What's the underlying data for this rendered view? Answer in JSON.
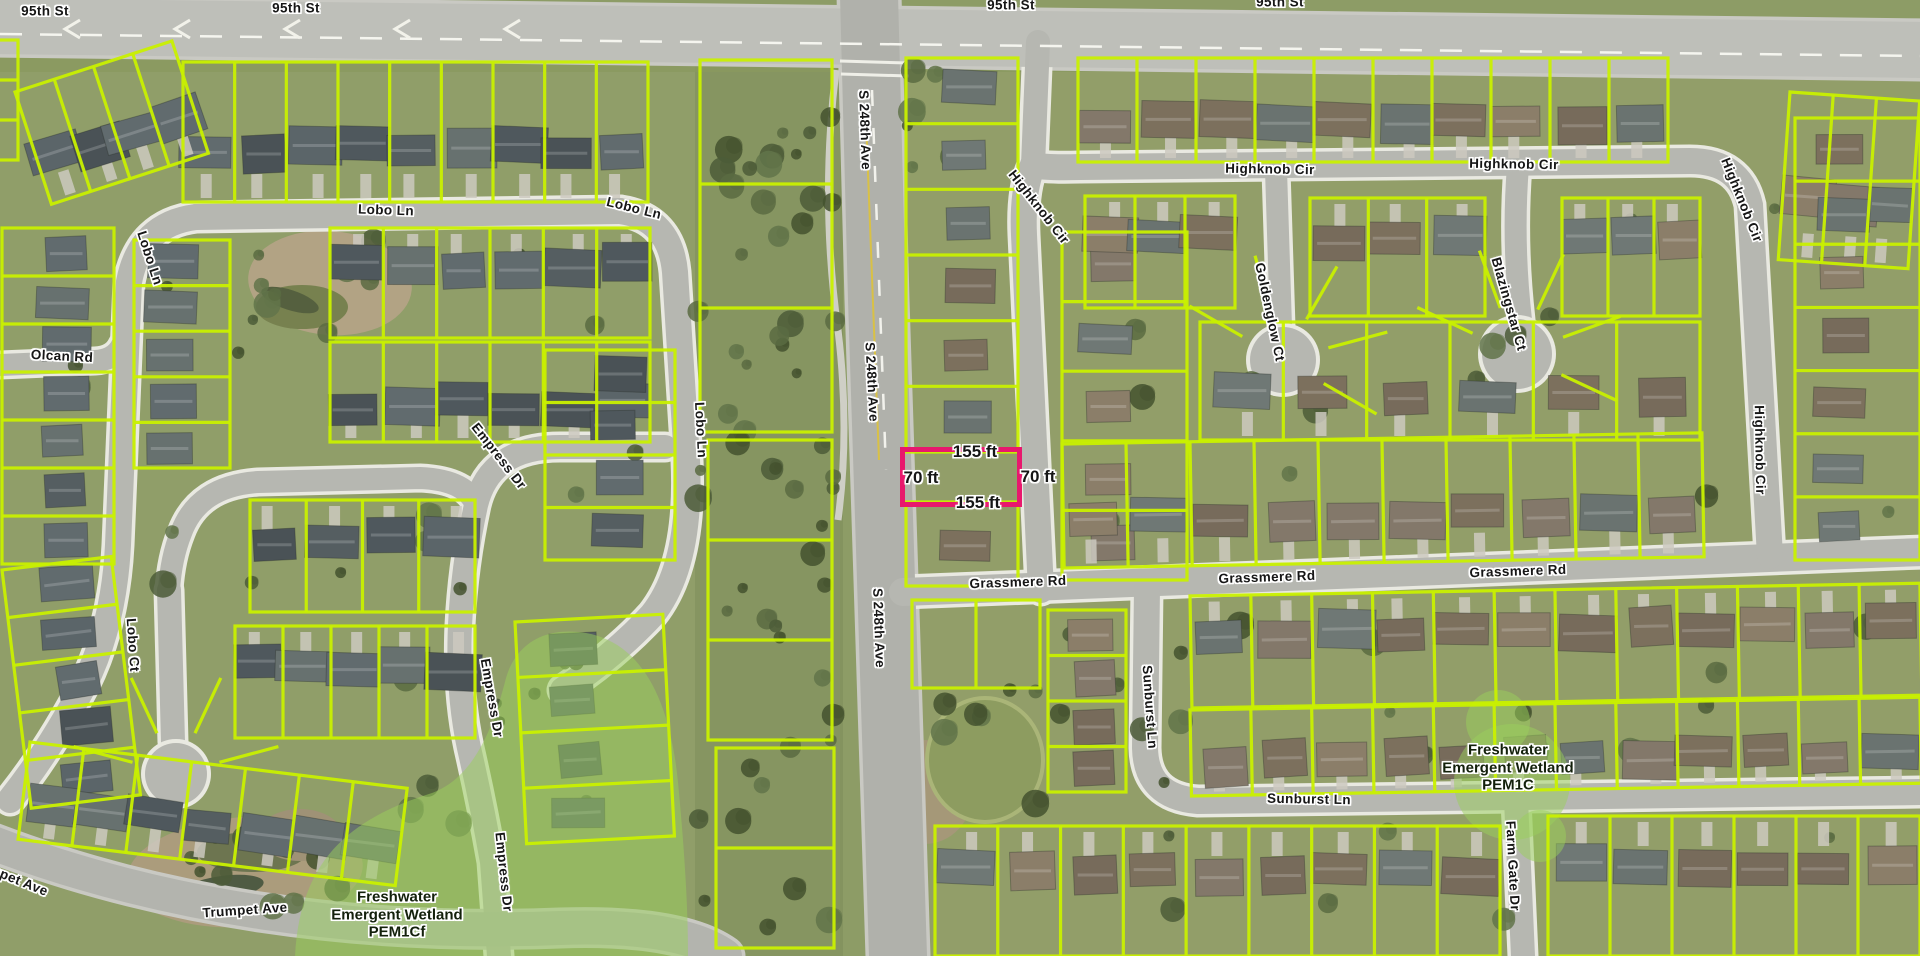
{
  "map": {
    "view_title": "Parcel map aerial view",
    "street_labels": [
      {
        "text": "95th St",
        "x": 45,
        "y": 11,
        "rot": 0
      },
      {
        "text": "95th St",
        "x": 296,
        "y": 8,
        "rot": 0
      },
      {
        "text": "95th St",
        "x": 1011,
        "y": 5,
        "rot": 0
      },
      {
        "text": "95th St",
        "x": 1280,
        "y": 2,
        "rot": 0
      },
      {
        "text": "Lobo Ln",
        "x": 386,
        "y": 210,
        "rot": 2
      },
      {
        "text": "Lobo Ln",
        "x": 634,
        "y": 208,
        "rot": 14
      },
      {
        "text": "Lobo Ln",
        "x": 150,
        "y": 258,
        "rot": 72
      },
      {
        "text": "Olcan Rd",
        "x": 62,
        "y": 356,
        "rot": 3
      },
      {
        "text": "Lobo Ct",
        "x": 133,
        "y": 645,
        "rot": 86
      },
      {
        "text": "Empress Dr",
        "x": 499,
        "y": 456,
        "rot": 52
      },
      {
        "text": "Empress Dr",
        "x": 492,
        "y": 698,
        "rot": 80
      },
      {
        "text": "Empress Dr",
        "x": 504,
        "y": 872,
        "rot": 84
      },
      {
        "text": "Lobo Ln",
        "x": 701,
        "y": 430,
        "rot": 87
      },
      {
        "text": "S 248th Ave",
        "x": 865,
        "y": 130,
        "rot": 88
      },
      {
        "text": "S 248th Ave",
        "x": 872,
        "y": 382,
        "rot": 87
      },
      {
        "text": "S 248th Ave",
        "x": 879,
        "y": 628,
        "rot": 88
      },
      {
        "text": "Highknob Cir",
        "x": 1039,
        "y": 207,
        "rot": 52
      },
      {
        "text": "Highknob Cir",
        "x": 1270,
        "y": 169,
        "rot": 1
      },
      {
        "text": "Highknob Cir",
        "x": 1514,
        "y": 164,
        "rot": 1
      },
      {
        "text": "Highknob Cir",
        "x": 1742,
        "y": 200,
        "rot": 68
      },
      {
        "text": "Highknob Cir",
        "x": 1760,
        "y": 450,
        "rot": 89
      },
      {
        "text": "Goldenglow Ct",
        "x": 1270,
        "y": 312,
        "rot": 78
      },
      {
        "text": "Blazingstar Ct",
        "x": 1509,
        "y": 304,
        "rot": 74
      },
      {
        "text": "Grassmere Rd",
        "x": 1018,
        "y": 582,
        "rot": -2
      },
      {
        "text": "Grassmere Rd",
        "x": 1267,
        "y": 577,
        "rot": -2
      },
      {
        "text": "Grassmere Rd",
        "x": 1518,
        "y": 571,
        "rot": -2
      },
      {
        "text": "Sunburst Ln",
        "x": 1150,
        "y": 707,
        "rot": 86
      },
      {
        "text": "Sunburst Ln",
        "x": 1309,
        "y": 799,
        "rot": 1
      },
      {
        "text": "Farm Gate Dr",
        "x": 1513,
        "y": 866,
        "rot": 87
      },
      {
        "text": "Trumpet Ave",
        "x": 245,
        "y": 910,
        "rot": -4
      },
      {
        "text": "Trumpet Ave",
        "x": 8,
        "y": 876,
        "rot": 22
      }
    ],
    "wetland_labels": [
      {
        "line1": "Freshwater",
        "line2": "Emergent Wetland",
        "line3": "PEM1Cf",
        "x": 397,
        "y": 915
      },
      {
        "line1": "Freshwater",
        "line2": "Emergent Wetland",
        "line3": "PEM1C",
        "x": 1508,
        "y": 768
      }
    ],
    "highlight": {
      "outline_color": "#e8186d",
      "dimensions": [
        {
          "text": "155 ft",
          "x": 975,
          "y": 452,
          "side": "top"
        },
        {
          "text": "70 ft",
          "x": 921,
          "y": 478,
          "side": "left"
        },
        {
          "text": "70 ft",
          "x": 1038,
          "y": 477,
          "side": "right"
        },
        {
          "text": "155 ft",
          "x": 978,
          "y": 503,
          "side": "bottom"
        }
      ]
    },
    "colors": {
      "parcel_line": "#c9f000",
      "highlight_outline": "#e8186d",
      "wetland_overlay": "rgba(154,208,92,0.5)",
      "road": "#b6b7b1"
    }
  }
}
